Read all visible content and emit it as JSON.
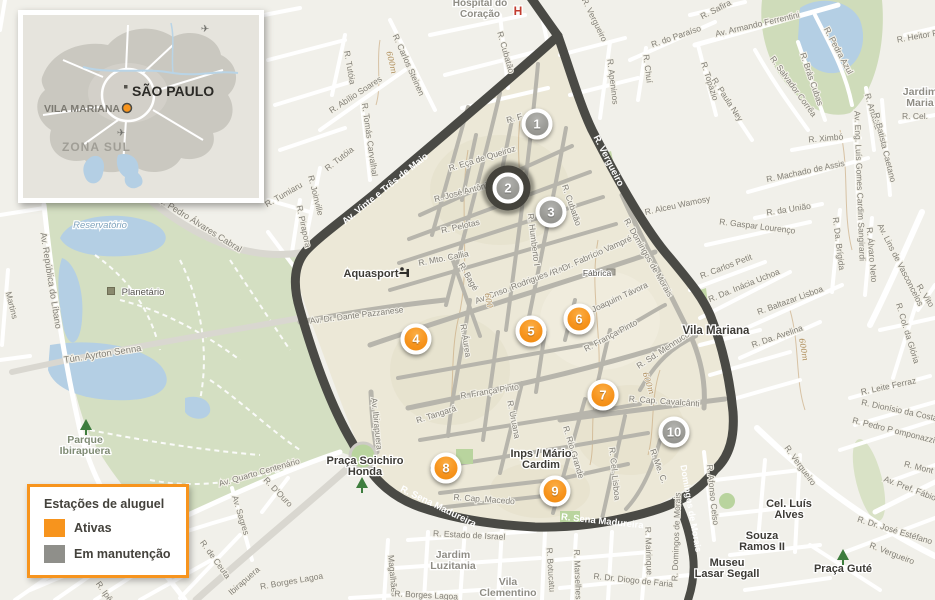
{
  "inset": {
    "city": "SÃO PAULO",
    "district": "VILA MARIANA",
    "zone": "ZONA SUL"
  },
  "legend": {
    "title": "Estações de aluguel",
    "items": [
      {
        "label": "Ativas",
        "color": "#F7941D",
        "status": "ativa"
      },
      {
        "label": "Em manutenção",
        "color": "#8F8F8A",
        "status": "manutencao"
      }
    ]
  },
  "stations": [
    {
      "number": 1,
      "status": "manutencao",
      "x": 537,
      "y": 124
    },
    {
      "number": 2,
      "status": "manutencao",
      "x": 508,
      "y": 188,
      "selected": true
    },
    {
      "number": 3,
      "status": "manutencao",
      "x": 551,
      "y": 212
    },
    {
      "number": 4,
      "status": "ativa",
      "x": 416,
      "y": 339
    },
    {
      "number": 5,
      "status": "ativa",
      "x": 531,
      "y": 331
    },
    {
      "number": 6,
      "status": "ativa",
      "x": 579,
      "y": 319
    },
    {
      "number": 7,
      "status": "ativa",
      "x": 603,
      "y": 395
    },
    {
      "number": 8,
      "status": "ativa",
      "x": 446,
      "y": 468
    },
    {
      "number": 9,
      "status": "ativa",
      "x": 555,
      "y": 491
    },
    {
      "number": 10,
      "status": "manutencao",
      "x": 674,
      "y": 432
    }
  ],
  "colors": {
    "active": "#F7941D",
    "maintenance": "#8F8F8A",
    "selected_ring": "#3F3E38",
    "region_fill": "#ECE8D7",
    "dark_road": "#4A4A45",
    "park_green": "#D4DFC2",
    "water_blue": "#B4CFE4"
  },
  "map": {
    "street_labels": [
      {
        "t": "R. Tutóia",
        "x": 347,
        "y": 68,
        "r": 80
      },
      {
        "t": "R. Carlos Steinen",
        "x": 406,
        "y": 66,
        "r": 66
      },
      {
        "t": "R. Abílio Soares",
        "x": 357,
        "y": 97,
        "r": -33
      },
      {
        "t": "R. Tomás Carvalhal",
        "x": 367,
        "y": 140,
        "r": 82
      },
      {
        "t": "R. Tutóia",
        "x": 341,
        "y": 161,
        "r": -38
      },
      {
        "t": "R. Joinville",
        "x": 313,
        "y": 196,
        "r": 76
      },
      {
        "t": "R. Tumiaru",
        "x": 285,
        "y": 197,
        "r": -30
      },
      {
        "t": "R. Pirapora",
        "x": 301,
        "y": 227,
        "r": 78
      },
      {
        "t": "R. Cubatão",
        "x": 503,
        "y": 53,
        "r": 74
      },
      {
        "t": "R. Vergueiro",
        "x": 592,
        "y": 21,
        "r": 64
      },
      {
        "t": "R. F",
        "x": 515,
        "y": 121,
        "r": -15
      },
      {
        "t": "R. Eça de Queiroz",
        "x": 483,
        "y": 161,
        "r": -17
      },
      {
        "t": "R. José Antônio C.",
        "x": 469,
        "y": 193,
        "r": -15
      },
      {
        "t": "R. Pelotas",
        "x": 461,
        "y": 229,
        "r": -13
      },
      {
        "t": "R. Humberto I",
        "x": 531,
        "y": 240,
        "r": 83
      },
      {
        "t": "R. Cubatão",
        "x": 569,
        "y": 206,
        "r": 71
      },
      {
        "t": "R. Mto. Callia",
        "x": 444,
        "y": 261,
        "r": -11
      },
      {
        "t": "R. Bagé",
        "x": 466,
        "y": 278,
        "r": 60
      },
      {
        "t": "Av. Cnso. Rodrigues Alves",
        "x": 523,
        "y": 286,
        "r": -21
      },
      {
        "t": "R. Dr. Fabrício Vampré",
        "x": 593,
        "y": 258,
        "r": -24
      },
      {
        "t": "Av. Dr. Dante Pazzanese",
        "x": 357,
        "y": 318,
        "r": -7
      },
      {
        "t": "R. Joaquim Távora",
        "x": 616,
        "y": 302,
        "r": -25
      },
      {
        "t": "R. Áurea",
        "x": 463,
        "y": 341,
        "r": 81
      },
      {
        "t": "R. França Pinto",
        "x": 612,
        "y": 338,
        "r": -28
      },
      {
        "t": "R. França Pinto",
        "x": 490,
        "y": 394,
        "r": -9
      },
      {
        "t": "R. Sd. Mennucci",
        "x": 665,
        "y": 352,
        "r": -33
      },
      {
        "t": "R. Cap. Cavalcânti",
        "x": 664,
        "y": 404,
        "r": 4
      },
      {
        "t": "R. Tangará",
        "x": 437,
        "y": 417,
        "r": -18
      },
      {
        "t": "R. Uruana",
        "x": 511,
        "y": 420,
        "r": 79
      },
      {
        "t": "R. Rio Grande",
        "x": 571,
        "y": 453,
        "r": 73
      },
      {
        "t": "R. Cel. Lisboa",
        "x": 612,
        "y": 474,
        "r": 84
      },
      {
        "t": "R. Me. C.",
        "x": 656,
        "y": 467,
        "r": 70
      },
      {
        "t": "Av. Ibirapuera",
        "x": 374,
        "y": 424,
        "r": 84
      },
      {
        "t": "R. Domingos de Morais",
        "x": 646,
        "y": 259,
        "r": 60
      },
      {
        "t": "R. Cap. Macedo",
        "x": 484,
        "y": 502,
        "r": 4
      },
      {
        "t": "Av. Vinte e Três de Maio",
        "x": 387,
        "y": 191,
        "r": -39,
        "c": "w",
        "s": 9.5
      },
      {
        "t": "R. Vergueiro",
        "x": 606,
        "y": 162,
        "r": 63,
        "c": "w",
        "s": 9.5
      },
      {
        "t": "R. Sena Madureira",
        "x": 437,
        "y": 509,
        "r": 26,
        "c": "w",
        "s": 9.5
      },
      {
        "t": "R. Sena Madureira",
        "x": 602,
        "y": 524,
        "r": 6,
        "c": "w",
        "s": 9.5
      },
      {
        "t": "Domingos de Morais",
        "x": 688,
        "y": 509,
        "r": 80,
        "c": "w",
        "s": 9
      },
      {
        "t": "R. Alceu Wamosy",
        "x": 678,
        "y": 208,
        "r": -12
      },
      {
        "t": "R. Apeninos",
        "x": 610,
        "y": 82,
        "r": 83
      },
      {
        "t": "R. Chuí",
        "x": 645,
        "y": 69,
        "r": 83
      },
      {
        "t": "R. do Paraíso",
        "x": 677,
        "y": 39,
        "r": -19
      },
      {
        "t": "R. Safira",
        "x": 717,
        "y": 12,
        "r": -27
      },
      {
        "t": "Av. Armando Ferrentini",
        "x": 758,
        "y": 27,
        "r": -13
      },
      {
        "t": "R. Topázio",
        "x": 707,
        "y": 82,
        "r": 72
      },
      {
        "t": "R. Paula Ney",
        "x": 725,
        "y": 101,
        "r": 57
      },
      {
        "t": "R. Salvador Corrêa",
        "x": 791,
        "y": 88,
        "r": 54
      },
      {
        "t": "R. Brás Cubas",
        "x": 809,
        "y": 80,
        "r": 71
      },
      {
        "t": "R. Pedra Azul",
        "x": 836,
        "y": 52,
        "r": 62
      },
      {
        "t": "R. Heitor Peixoto",
        "x": 929,
        "y": 37,
        "r": -10
      },
      {
        "t": "R. Ximbó",
        "x": 826,
        "y": 141,
        "r": -5
      },
      {
        "t": "R. Machado de Assis",
        "x": 806,
        "y": 174,
        "r": -12
      },
      {
        "t": "R. Anadia",
        "x": 870,
        "y": 112,
        "r": 73
      },
      {
        "t": "R. Batista Caetano",
        "x": 882,
        "y": 148,
        "r": 76
      },
      {
        "t": "Av. Eng. Luís Gomes Cardim Sangirardi",
        "x": 857,
        "y": 186,
        "r": 88
      },
      {
        "t": "R. Cel.",
        "x": 915,
        "y": 119,
        "r": 0
      },
      {
        "t": "R. da União",
        "x": 789,
        "y": 212,
        "r": -9
      },
      {
        "t": "R. Gaspar Lourenço",
        "x": 757,
        "y": 229,
        "r": 7
      },
      {
        "t": "R. Carlos Petit",
        "x": 727,
        "y": 269,
        "r": -21
      },
      {
        "t": "R. Da. Inácia Uchoa",
        "x": 745,
        "y": 288,
        "r": -22
      },
      {
        "t": "R. Baltazar Lisboa",
        "x": 791,
        "y": 303,
        "r": -20
      },
      {
        "t": "R. Da. Avelina",
        "x": 778,
        "y": 339,
        "r": -19
      },
      {
        "t": "R. Da. Brígida",
        "x": 836,
        "y": 244,
        "r": 83
      },
      {
        "t": "R. Álvaro Neto",
        "x": 869,
        "y": 255,
        "r": 85
      },
      {
        "t": "Av. Lins de Vasconcelos",
        "x": 898,
        "y": 266,
        "r": 63
      },
      {
        "t": "R. Col. da Glória",
        "x": 905,
        "y": 334,
        "r": 73
      },
      {
        "t": "R. Leite Ferraz",
        "x": 889,
        "y": 389,
        "r": -12
      },
      {
        "t": "R. Vito",
        "x": 923,
        "y": 297,
        "r": 58
      },
      {
        "t": "R. Vergueiro",
        "x": 798,
        "y": 467,
        "r": 54
      },
      {
        "t": "R. Vergueiro",
        "x": 891,
        "y": 556,
        "r": 21
      },
      {
        "t": "R. Dionísio da Costa",
        "x": 899,
        "y": 413,
        "r": 12
      },
      {
        "t": "R. Pedro P omponazzi",
        "x": 893,
        "y": 433,
        "r": 14
      },
      {
        "t": "R. Mont",
        "x": 918,
        "y": 470,
        "r": 14
      },
      {
        "t": "Av. Pref. Fábio",
        "x": 909,
        "y": 491,
        "r": 21
      },
      {
        "t": "R. Dr. José Estéfano",
        "x": 894,
        "y": 533,
        "r": 17
      },
      {
        "t": "R. Afonso Celso",
        "x": 710,
        "y": 495,
        "r": 84
      },
      {
        "t": "R. Estado de Israel",
        "x": 469,
        "y": 538,
        "r": 3
      },
      {
        "t": "R. Botucatu",
        "x": 548,
        "y": 570,
        "r": 86
      },
      {
        "t": "R. Marselhesa",
        "x": 575,
        "y": 577,
        "r": 88
      },
      {
        "t": "R. Dr. Diogo de Faria",
        "x": 633,
        "y": 583,
        "r": 6
      },
      {
        "t": "R. Mairinque",
        "x": 646,
        "y": 551,
        "r": 88
      },
      {
        "t": "R. Domingos de Morais",
        "x": 679,
        "y": 537,
        "r": -88
      },
      {
        "t": "Magalhães",
        "x": 390,
        "y": 576,
        "r": 85
      },
      {
        "t": "R. Borges Lagoa",
        "x": 426,
        "y": 598,
        "r": 3
      },
      {
        "t": "R. Borges Lagoa",
        "x": 292,
        "y": 584,
        "r": -10
      },
      {
        "t": "R. Ipê",
        "x": 102,
        "y": 593,
        "r": 55
      },
      {
        "t": "Av. Pedro Álvares Cabral",
        "x": 197,
        "y": 226,
        "r": 32,
        "s": 9
      },
      {
        "t": "Av. República do Líbano",
        "x": 48,
        "y": 281,
        "r": 81,
        "s": 9
      },
      {
        "t": "Martins",
        "x": 9,
        "y": 306,
        "r": 76
      },
      {
        "t": "Tún. Ayrton Senna",
        "x": 103,
        "y": 357,
        "r": -9,
        "s": 9.5
      },
      {
        "t": "Av. Quarto Centenário",
        "x": 260,
        "y": 475,
        "r": -16
      },
      {
        "t": "Av. Sagres",
        "x": 238,
        "y": 516,
        "r": 73
      },
      {
        "t": "R. D'Ouro",
        "x": 276,
        "y": 494,
        "r": 46
      },
      {
        "t": "R. de Ceuta",
        "x": 213,
        "y": 561,
        "r": 54
      },
      {
        "t": "Ibirapuera",
        "x": 246,
        "y": 583,
        "r": -41
      },
      {
        "t": "600m",
        "x": 389,
        "y": 63,
        "r": 76,
        "c": "ct",
        "s": 8
      },
      {
        "t": "600",
        "x": 486,
        "y": 301,
        "r": 80,
        "c": "ct",
        "s": 8
      },
      {
        "t": "600m",
        "x": 646,
        "y": 384,
        "r": 72,
        "c": "ct",
        "s": 8
      },
      {
        "t": "600m",
        "x": 801,
        "y": 350,
        "r": 80,
        "c": "ct",
        "s": 8
      }
    ],
    "places": [
      {
        "lines": [
          "Hospital do",
          "Coração"
        ],
        "x": 480,
        "y": 6,
        "cls": "area",
        "s": 10
      },
      {
        "lines": [
          "H"
        ],
        "x": 518,
        "y": 15,
        "cls": "red",
        "s": 12
      },
      {
        "lines": [
          "Aquasport"
        ],
        "x": 371,
        "y": 277,
        "cls": "place",
        "s": 11
      },
      {
        "lines": [
          "Praça Soichiro",
          "Honda"
        ],
        "x": 365,
        "y": 464,
        "cls": "place",
        "s": 11
      },
      {
        "lines": [
          "Inps / Mário",
          "Cardim"
        ],
        "x": 541,
        "y": 457,
        "cls": "place",
        "s": 11
      },
      {
        "lines": [
          "Vila Mariana"
        ],
        "x": 716,
        "y": 334,
        "cls": "place",
        "s": 11.5
      },
      {
        "lines": [
          "Cel. Luís",
          "Alves"
        ],
        "x": 789,
        "y": 507,
        "cls": "place",
        "s": 11
      },
      {
        "lines": [
          "Souza",
          "Ramos II"
        ],
        "x": 762,
        "y": 539,
        "cls": "place",
        "s": 11
      },
      {
        "lines": [
          "Museu",
          "Lasar Segall"
        ],
        "x": 727,
        "y": 566,
        "cls": "place",
        "s": 11
      },
      {
        "lines": [
          "Praça Guté"
        ],
        "x": 843,
        "y": 572,
        "cls": "place",
        "s": 11
      },
      {
        "lines": [
          "Jardim",
          "Luzitania"
        ],
        "x": 453,
        "y": 558,
        "cls": "area",
        "s": 10.5
      },
      {
        "lines": [
          "Jardim",
          "Maria"
        ],
        "x": 920,
        "y": 95,
        "cls": "area",
        "s": 10.5
      },
      {
        "lines": [
          "Vila",
          "Clementino"
        ],
        "x": 508,
        "y": 585,
        "cls": "area",
        "s": 10.5
      },
      {
        "lines": [
          "Parque",
          "Ibirapuera"
        ],
        "x": 85,
        "y": 443,
        "cls": "park",
        "s": 10.5
      },
      {
        "lines": [
          "Planetário"
        ],
        "x": 143,
        "y": 295,
        "cls": "poi",
        "s": 9.5
      },
      {
        "lines": [
          "Fábrica"
        ],
        "x": 597,
        "y": 276,
        "cls": "poi",
        "s": 8.5
      },
      {
        "lines": [
          "Reservatório"
        ],
        "x": 100,
        "y": 228,
        "cls": "water",
        "s": 9.5
      }
    ],
    "icons": [
      {
        "name": "tree-icon",
        "x": 86,
        "y": 428
      },
      {
        "name": "tree-icon",
        "x": 362,
        "y": 486
      },
      {
        "name": "tree-icon",
        "x": 843,
        "y": 558
      },
      {
        "name": "dumbbell-icon",
        "x": 402,
        "y": 273
      },
      {
        "name": "planetarium-icon",
        "x": 111,
        "y": 291
      },
      {
        "name": "factory-icon",
        "x": 611,
        "y": 272
      },
      {
        "name": "airplane-icon",
        "ctx": "inset",
        "x": 182,
        "y": 13
      },
      {
        "name": "airplane-icon",
        "ctx": "inset",
        "x": 98,
        "y": 117
      }
    ]
  }
}
